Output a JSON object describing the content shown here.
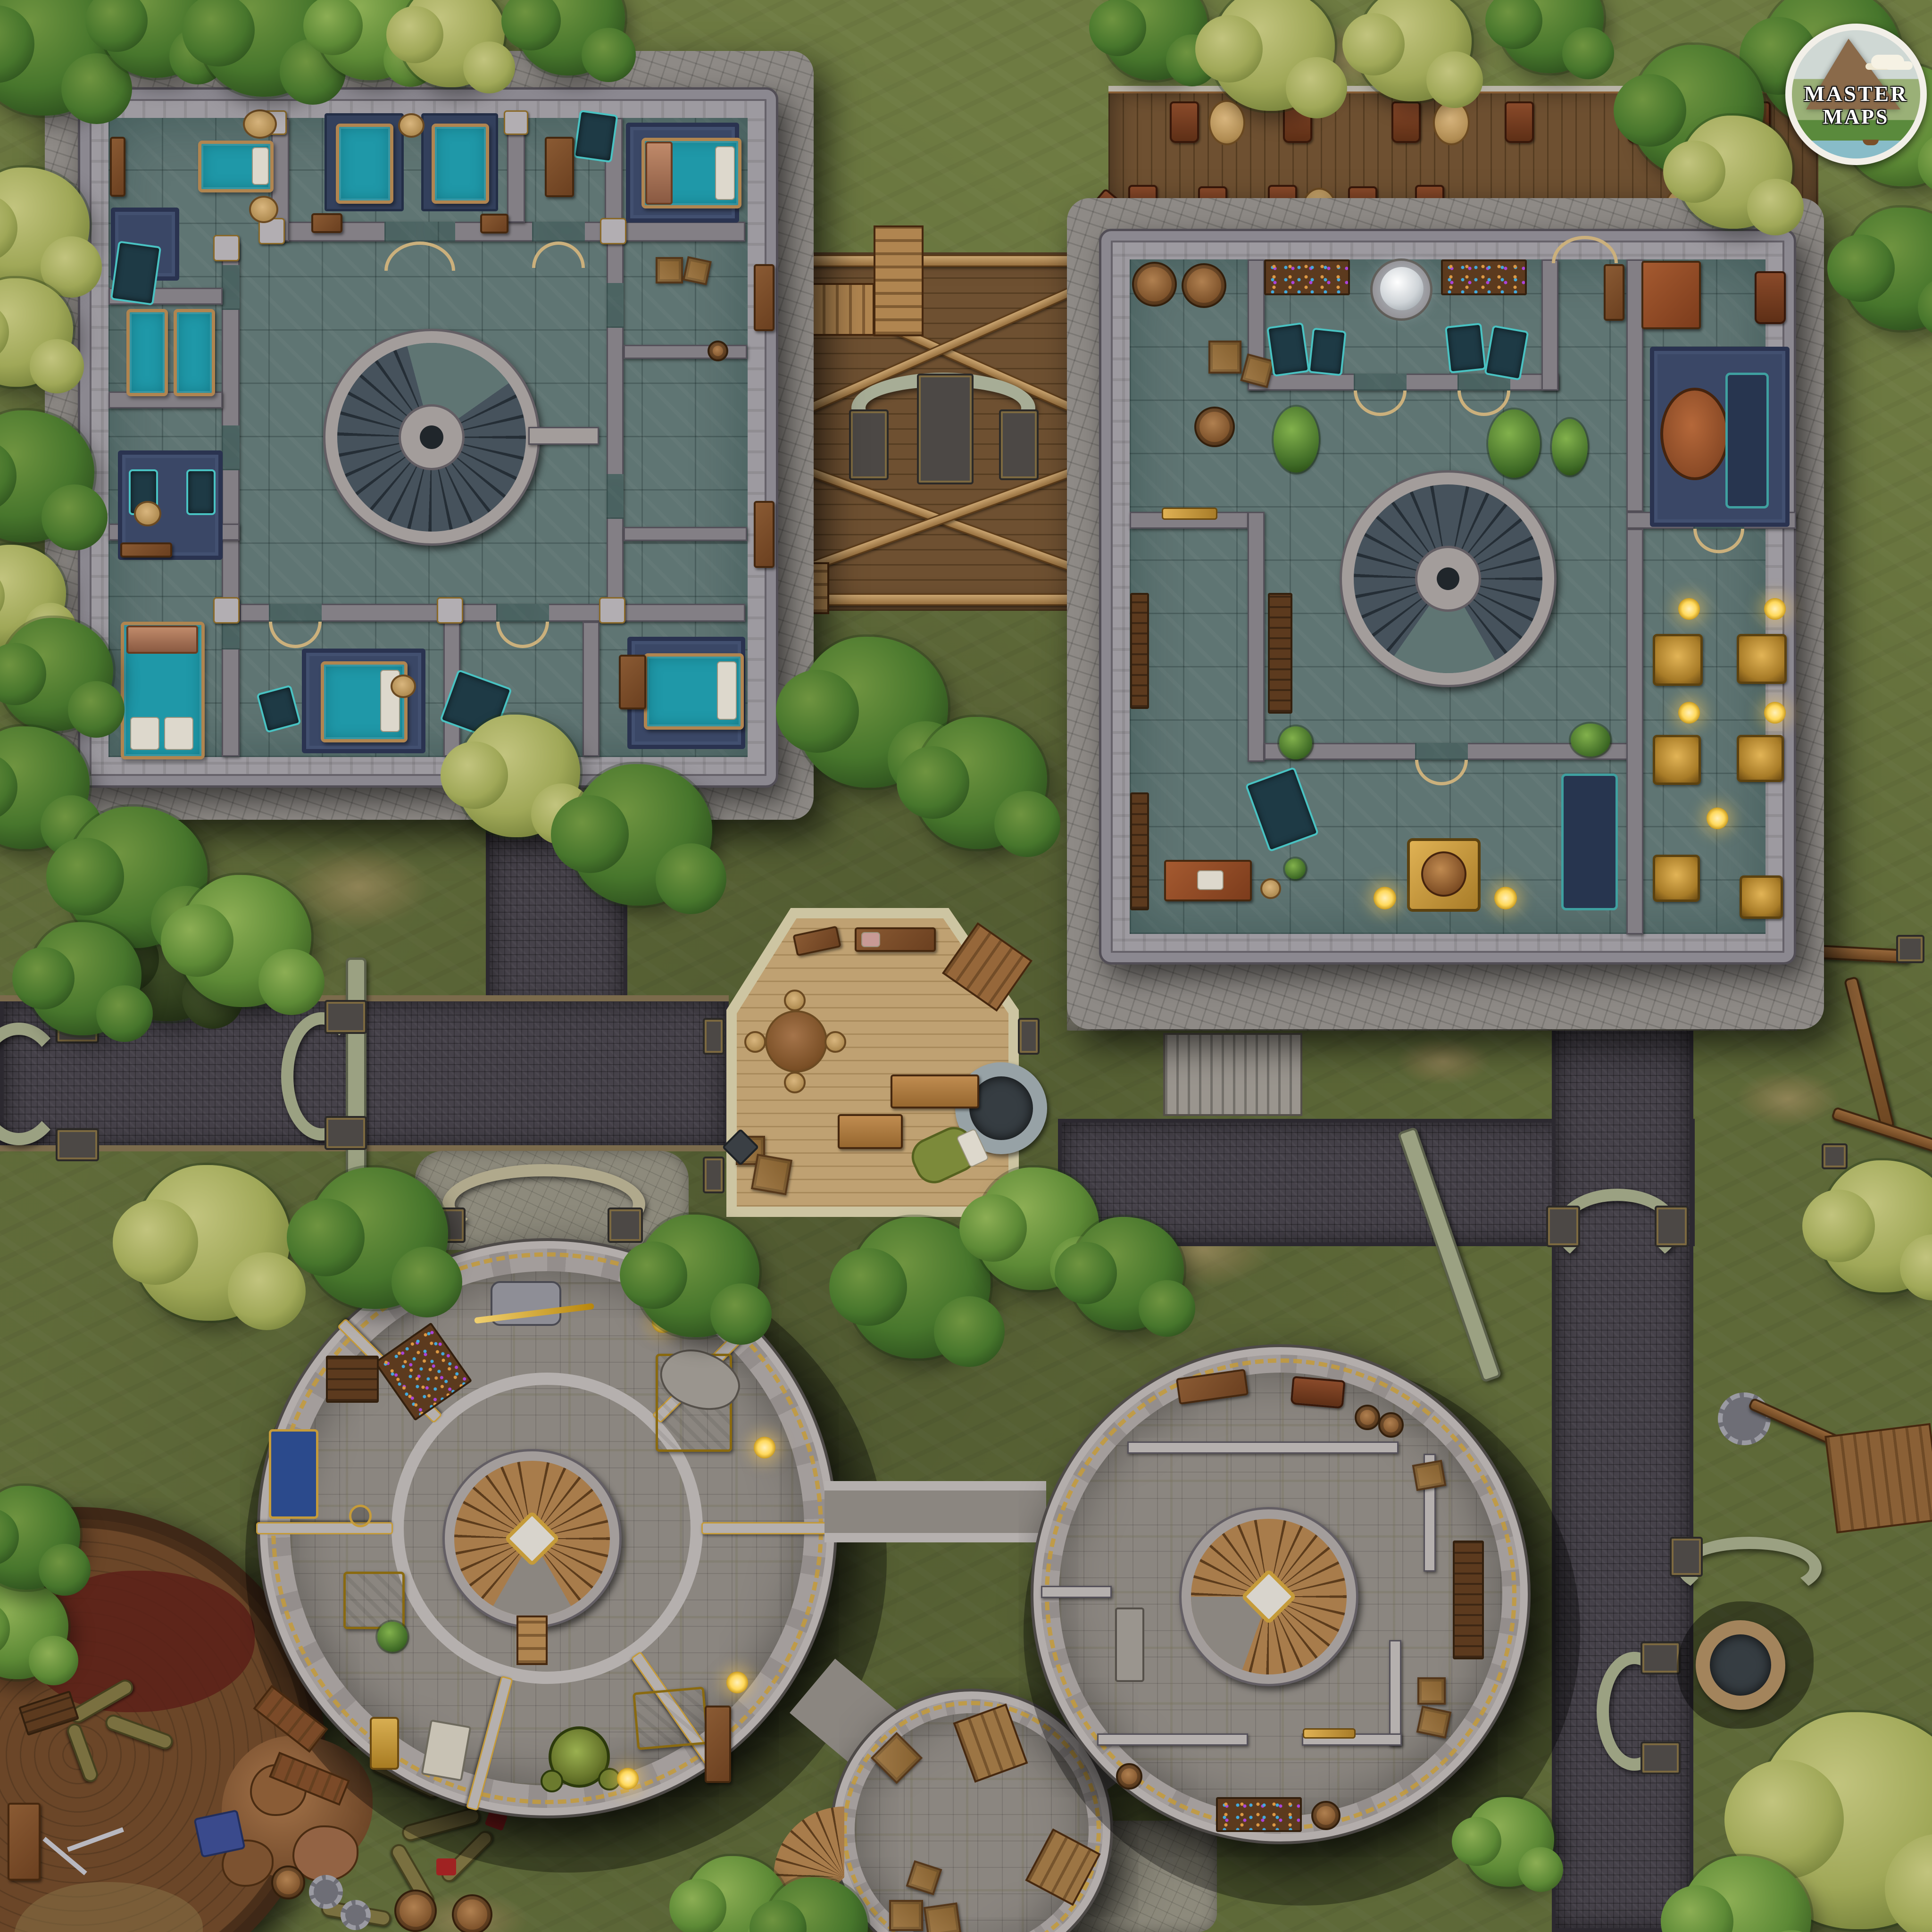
{
  "title": "fantasy-town-battlemap",
  "logo": {
    "line1": "MASTER",
    "line2": "MAPS"
  },
  "palette": {
    "grass": "#6e7b42",
    "dirt": "#9b8a5d",
    "road": "#46424a",
    "roadTrim": "#7b6b4c",
    "plaza": "#8d8a7c",
    "moss": "#9ba182",
    "postDark": "#4c4845",
    "apron": "#8e8a86",
    "wall": "#9d9aa0",
    "iwall": "#837f85",
    "pillar": "#b2aeb2",
    "floorTeal": "#5f7573",
    "doorTan": "#cbb07c",
    "gold": "#c59b3a",
    "stoneRing": "#a39d9b",
    "slate": "#46525c",
    "woodStep": "#a87c4b",
    "towerFloor": "#8b8680",
    "towerWall": "#b5b0ae",
    "bedTeal": "#1f98a8",
    "bedFrame": "#b08550",
    "pillowC": "#ddd8cc",
    "rug": "#3a4766",
    "chairTeal": "#1e3a45",
    "deckWood": "#6e5031",
    "hexFloor": "#bfa172",
    "hexRim": "#cdc5a2",
    "platWood": "#6b4628",
    "blood": "#5c2018",
    "tentacle": "#7a7040",
    "lamp": "#ffd95c",
    "yellowTable": "#d8a821",
    "blueDesk": "#2b4a8c",
    "greenDevice": "#6b7a2e",
    "wellRing": "#a3845c",
    "hill": "#5a8a3c",
    "water": "#88bcc8",
    "mountain": "#8a6a4a"
  },
  "features": [
    "northwest-dormitory-building",
    "stone-spiral-staircase",
    "bedrooms-with-teal-beds",
    "wooden-bridge-deck",
    "stone-arch-bench",
    "wooden-stairs",
    "northeast-hall-building",
    "wooden-terrace-with-chairs",
    "crystal-moon-pedestal",
    "wine-racks",
    "barrels",
    "gold-statue-room",
    "blue-carpet-lounge",
    "spiral-staircase",
    "hexagonal-workshop",
    "round-table",
    "stone-well",
    "workbenches",
    "bedroll",
    "southwest-round-tower",
    "wooden-spiral-stair",
    "arcane-tables",
    "orb-device",
    "southeast-round-tower",
    "small-round-depot",
    "crates",
    "wooden-platform-with-slain-giant",
    "tentacled-carcass",
    "blood-stain",
    "cobblestone-roads",
    "bridge-parapets",
    "dark-well",
    "construction-scaffolds",
    "trees",
    "master-maps-logo"
  ]
}
